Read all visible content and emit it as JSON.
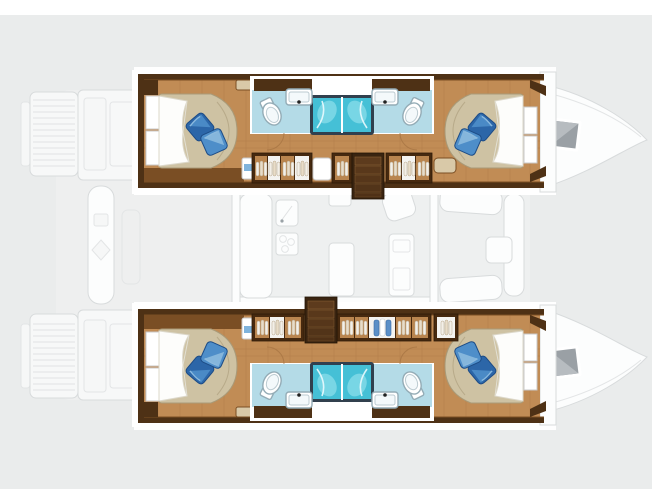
{
  "meta": {
    "title": "catamaran-floor-plan",
    "description": "Top-down layout plan of a sailing catamaran: two accommodation hulls rendered in colour (4 double cabins, 4 bathrooms with showers, wardrobes, companionway stairs), ghosted deck plan between them (swim platforms, aft cockpit, saloon with galley and chart table, forward cockpit, bow deck hatches)."
  },
  "colors": {
    "bg": "#eaecec",
    "band": "#ffffff",
    "ghostFill": "#f7f8f8",
    "ghostStroke": "#d8dbdc",
    "ghostFaint": "#e3e5e6",
    "ghostLine": "#dfe1e2",
    "ghostDeck": "#f0f2f2",
    "salonDeck": "#eef0f0",
    "hullDark": "#4e3115",
    "hullMid": "#7a4e24",
    "woodFloor": "#c18c55",
    "woodLine": "#a87543",
    "cabinetFrame": "#46290f",
    "cabinetTan": "#b9854f",
    "stairsDark": "#3a2410",
    "stairsStep": "#5d3b1d",
    "stairsEdge": "#8a6134",
    "bedBeige": "#cec2a3",
    "bedEdge": "#a99a78",
    "sheet": "#fdfdfb",
    "pillowDark": "#2c66a8",
    "pillowMid": "#4e8ec9",
    "pillowLight": "#8cbade",
    "pillowStroke": "#1d4c86",
    "bathFloor": "#b4dbe7",
    "fixtureStroke": "#94acb6",
    "showerFrame": "#31404e",
    "showerCyan": "#45c0d6",
    "showerLight": "#8adeea",
    "benchTan": "#d9c9a8",
    "panelStroke": "#c9c9c9",
    "doorArc": "#a87543",
    "hatchGray": "#9aa0a5",
    "hatchLight": "#b7bcc0",
    "clothesBlue": "#5b8fc7"
  },
  "regions": {
    "upper_hull": [
      "aft cabin with double bed",
      "aft bathroom",
      "twin shower stalls",
      "forward bathroom",
      "forward cabin with double bed",
      "wardrobe lockers",
      "companionway stairs",
      "bow with deck hatch"
    ],
    "lower_hull": [
      "aft cabin with double bed",
      "aft bathroom",
      "twin shower stalls",
      "forward bathroom",
      "forward cabin with double bed",
      "wardrobe lockers",
      "companionway stairs",
      "bow with deck hatch"
    ],
    "deck_ghost": [
      "swim platforms",
      "transom steps",
      "aft cockpit bench",
      "saloon",
      "galley sink",
      "stove",
      "saloon table",
      "chart table",
      "forward cockpit seats",
      "forward cockpit table",
      "bow deck hatches"
    ]
  }
}
